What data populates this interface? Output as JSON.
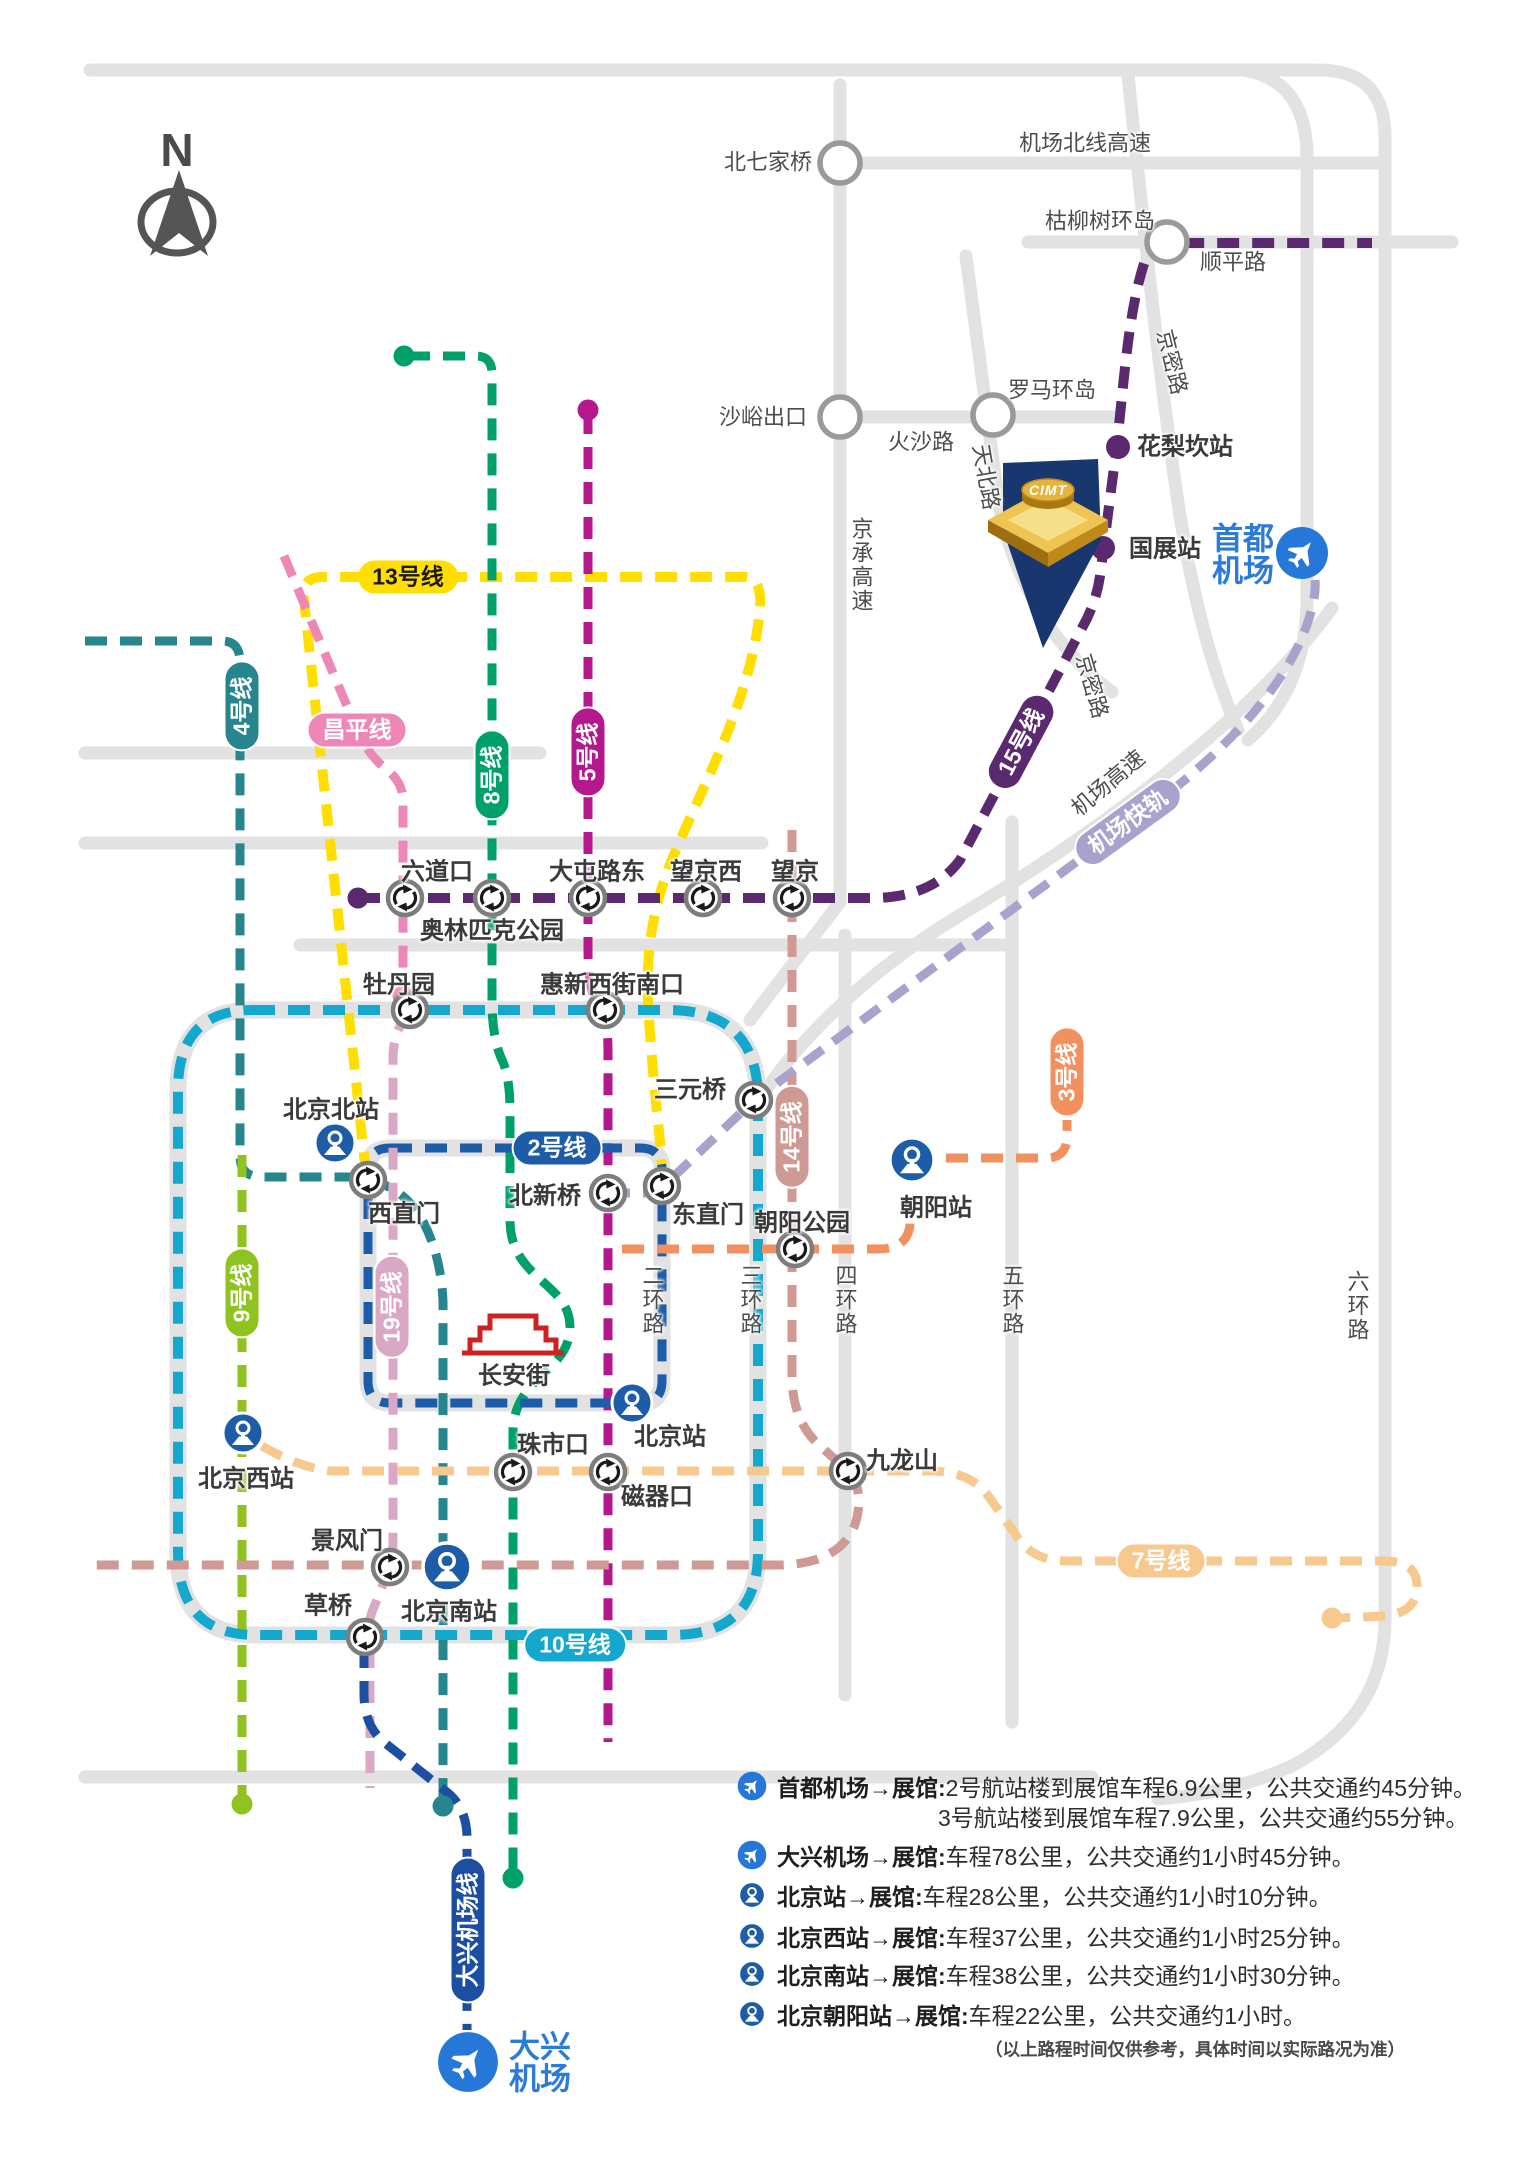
{
  "north_label": "N",
  "venue": {
    "logo": "CIMT"
  },
  "airports": {
    "capital_l1": "首都",
    "capital_l2": "机场",
    "daxing_l1": "大兴",
    "daxing_l2": "机场"
  },
  "pills": {
    "l13": "13号线",
    "l4": "4号线",
    "changping": "昌平线",
    "l8": "8号线",
    "l5": "5号线",
    "l15": "15号线",
    "airport_express": "机场快轨",
    "l2": "2号线",
    "l14": "14号线",
    "l3": "3号线",
    "l9": "9号线",
    "l19": "19号线",
    "l10": "10号线",
    "l7": "7号线",
    "daxing_line": "大兴机场线"
  },
  "stations": {
    "liudaokou": "六道口",
    "olympic": "奥林匹克公园",
    "datunludong": "大屯路东",
    "wangjingxi": "望京西",
    "wangjing": "望京",
    "mudanyuan": "牡丹园",
    "huixinxijienankou": "惠新西街南口",
    "sanyuanqiao": "三元桥",
    "xizhimen": "西直门",
    "beixinqiao": "北新桥",
    "dongzhimen": "东直门",
    "chaoyanggongyuan": "朝阳公园",
    "zhushikou": "珠市口",
    "ciqikou": "磁器口",
    "jingfengmen": "景风门",
    "caoqiao": "草桥",
    "jiulongshan": "九龙山",
    "hualikan": "花梨坎站",
    "guozhan": "国展站"
  },
  "road_stations": {
    "beiqijiaqiao": "北七家桥",
    "kuliushuhuandao": "枯柳树环岛",
    "shayuchukou": "沙峪出口",
    "luomahuandao": "罗马环岛"
  },
  "rail_stations": {
    "beijingbei": "北京北站",
    "beijing": "北京站",
    "beijingxi": "北京西站",
    "beijingnan": "北京南站",
    "chaoyang": "朝阳站"
  },
  "road_labels": {
    "jichang_beixian_gaosu": "机场北线高速",
    "shunping_lu": "顺平路",
    "jingmi_lu_1": "京密路",
    "jingmi_lu_2": "京密路",
    "huosha_lu": "火沙路",
    "tianbei_lu": "天北路",
    "jingcheng_gaosu": "京承高速",
    "jichang_gaosu": "机场高速",
    "ring2": "二环路",
    "ring3": "三环路",
    "ring4": "四环路",
    "ring5": "五环路",
    "ring6": "六环路",
    "changan_jie": "长安街"
  },
  "legend": {
    "rows": [
      {
        "icon": "plane",
        "title": "首都机场→展馆:",
        "line1": "2号航站楼到展馆车程6.9公里，公共交通约45分钟。",
        "line2": "3号航站楼到展馆车程7.9公里，公共交通约55分钟。"
      },
      {
        "icon": "plane",
        "title": "大兴机场→展馆:",
        "line1": "车程78公里，公共交通约1小时45分钟。"
      },
      {
        "icon": "rail",
        "title": "北京站→展馆:",
        "line1": "车程28公里，公共交通约1小时10分钟。"
      },
      {
        "icon": "rail",
        "title": "北京西站→展馆:",
        "line1": "车程37公里，公共交通约1小时25分钟。"
      },
      {
        "icon": "rail",
        "title": "北京南站→展馆:",
        "line1": "车程38公里，公共交通约1小时30分钟。"
      },
      {
        "icon": "rail",
        "title": "北京朝阳站→展馆:",
        "line1": "车程22公里，公共交通约1小时。"
      }
    ],
    "footnote": "（以上路程时间仅供参考，具体时间以实际路况为准）"
  },
  "colors": {
    "line15": "#5B2A6E",
    "line13": "#FFDE00",
    "changping": "#EC87B7",
    "line8": "#00A06A",
    "line5": "#B5188C",
    "line4": "#27858E",
    "line2": "#1C5CA8",
    "line10": "#14A8CE",
    "line9": "#8FC31F",
    "line19": "#D9A8C5",
    "line14": "#CE9A93",
    "line3": "#F2915F",
    "line7": "#F7C98F",
    "airport_express": "#A7A3CC",
    "daxing_line": "#1C4FA1",
    "rail_blue": "#1D5CA8",
    "airport_blue": "#2577D8",
    "road": "#E2E2E2",
    "venue_navy": "#17376E",
    "gold": "#E9B93E"
  }
}
